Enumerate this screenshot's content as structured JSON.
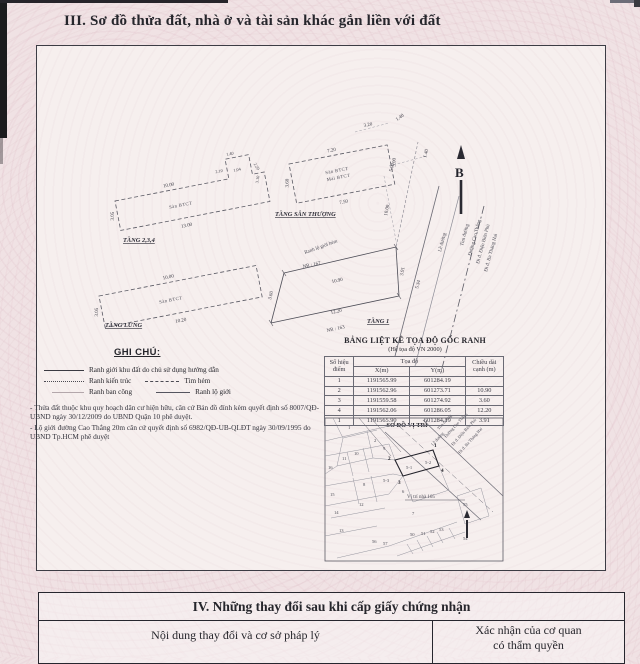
{
  "document": {
    "section3_title": "III. Sơ đồ thửa đất, nhà ở và tài sản khác gắn liền với đất",
    "section4_title": "IV. Những thay đổi sau khi cấp giấy chứng nhận",
    "section4_col_change": "Nội dung thay đổi và cơ sở pháp lý",
    "section4_col_confirm_1": "Xác nhận của cơ quan",
    "section4_col_confirm_2": "có thẩm quyền"
  },
  "north_label": "B",
  "floor_plans": {
    "tang234": {
      "name": "TẦNG 2,3,4",
      "material": "Sàn BTCT",
      "dim_top": "10.00",
      "dim_bottom": "13.00",
      "dim_left": "3.05",
      "dim_n1": "1.40",
      "dim_n2": "2.10",
      "dim_n3": "1.04",
      "dim_n4": "2.29",
      "dim_n5": "3.10"
    },
    "tang_san_thuong": {
      "name": "TẦNG SÂN THƯỢNG",
      "material1": "Sàn BTCT",
      "material2": "Mái BTCT",
      "dim_top": "7.20",
      "dim_bottom": "7.50",
      "dim_left": "3.60",
      "dim_right": "3.00"
    },
    "tang_lung": {
      "name": "TẦNG LỬNG",
      "material": "Sàn BTCT",
      "dim_top": "10.00",
      "dim_bottom": "10.20",
      "dim_left": "3.05"
    },
    "tang1": {
      "name": "TẦNG 1",
      "neighbor_top": "NR : 167",
      "neighbor_bottom": "NR : 163",
      "dim_top": "10.90",
      "dim_bottom": "12.20",
      "dim_left": "3.60",
      "dim_right": "3.91",
      "dim_street": "5.34",
      "boundary_label": "Ranh lộ giới hẻm"
    }
  },
  "site_dims": {
    "d1": "3.20",
    "d2": "1.40",
    "d3": "1.40",
    "d4": "5.00",
    "d5": "10.00"
  },
  "street": {
    "tim_duong": "Tim đường",
    "name": "Đường Cao Thắng",
    "dir1": "Đi đ. Điện Biên Phủ",
    "dir2": "Đi đ. Ba Tháng Hai",
    "le_duong": "Lề đường"
  },
  "legend": {
    "heading": "GHI CHÚ:",
    "item_boundary": "Ranh giới khu đất do chủ sử dụng hướng dẫn",
    "item_architecture": "Ranh kiến trúc",
    "item_alley": "Tim hẻm",
    "item_balcony": "Ranh ban công",
    "item_row": "Ranh lộ giới",
    "note1": "- Thửa đất thuộc khu quy hoạch dân cư hiện hữu, căn cứ Bản đồ đính kèm quyết định số 8007/QĐ-UBND ngày 30/12/2009 do UBND Quận 10 phê duyệt.",
    "note2": "- Lộ giới đường Cao Thắng 20m căn cứ quyết định số 6982/QĐ-UB-QLĐT ngày 30/09/1995 do UBND Tp.HCM phê duyệt"
  },
  "coord_table": {
    "title": "BẢNG LIỆT KÊ TỌA ĐỘ GỐC RANH",
    "subtitle": "(Hệ tọa độ VN 2000)",
    "col_point": "Số hiệu điểm",
    "col_coords": "Tọa độ",
    "col_x": "X(m)",
    "col_y": "Y(m)",
    "col_len": "Chiều dài cạnh (m)",
    "rows": [
      [
        "1",
        "1191565.99",
        "601284.19",
        ""
      ],
      [
        "2",
        "1191562.96",
        "601273.71",
        "10.90"
      ],
      [
        "3",
        "1191559.58",
        "601274.92",
        "3.60"
      ],
      [
        "4",
        "1191562.06",
        "601286.05",
        "12.20"
      ],
      [
        "1",
        "1191565.90",
        "601284.19",
        "3.91"
      ]
    ]
  },
  "location_map": {
    "title": "SƠ ĐỒ VỊ TRÍ",
    "site_label": "Vị trí nhà 165",
    "parcels": [
      "1",
      "2",
      "9",
      "10",
      "11",
      "16",
      "15",
      "12",
      "14",
      "13",
      "8",
      "6",
      "7",
      "5-1",
      "5-2",
      "5-3",
      "50",
      "51",
      "52",
      "53",
      "54",
      "55",
      "56",
      "57"
    ],
    "points": [
      "1",
      "2",
      "3",
      "4"
    ]
  }
}
